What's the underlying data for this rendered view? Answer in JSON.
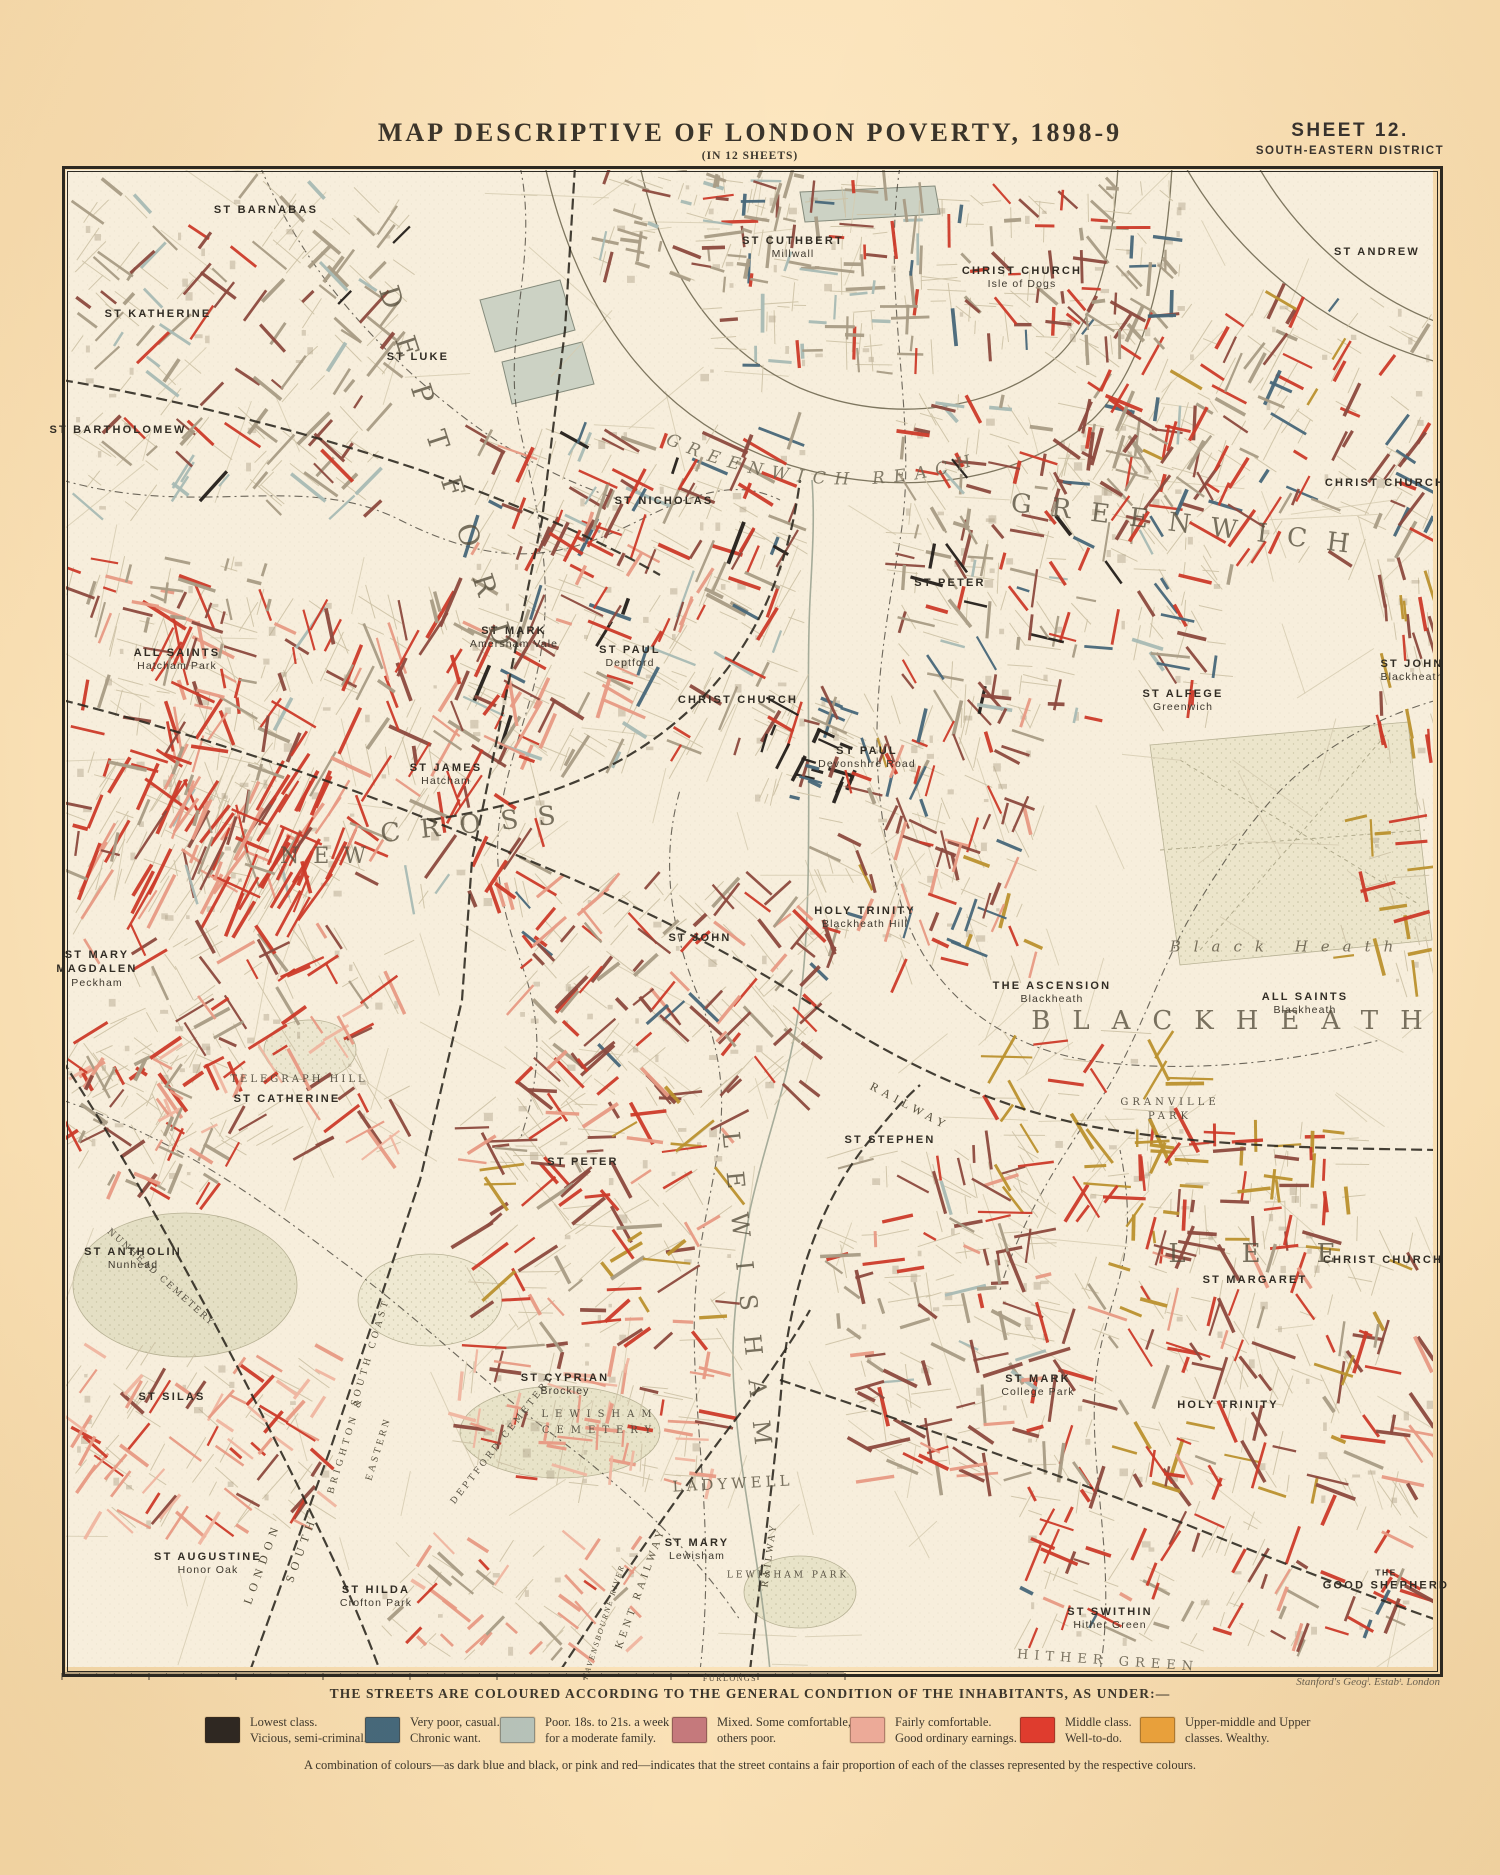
{
  "header": {
    "title": "MAP DESCRIPTIVE OF LONDON POVERTY, 1898-9",
    "subtitle": "(IN 12 SHEETS)",
    "sheet_no": "SHEET 12.",
    "district": "SOUTH-EASTERN DISTRICT"
  },
  "attribution": "Stanford's Geogˡ. Estabᵗ. London",
  "scale_bar": {
    "label": "FURLONGS"
  },
  "legend": {
    "heading": "THE STREETS ARE COLOURED ACCORDING TO THE GENERAL CONDITION OF THE INHABITANTS, AS UNDER:—",
    "items": [
      {
        "color": "#2a2522",
        "lx": 205,
        "lines": [
          "Lowest class.",
          "Vicious, semi-criminal."
        ]
      },
      {
        "color": "#44687c",
        "lx": 365,
        "lines": [
          "Very poor, casual.",
          "Chronic want."
        ]
      },
      {
        "color": "#b7c3ba",
        "lx": 500,
        "lines": [
          "Poor.  18s. to 21s. a week",
          "for a moderate family."
        ]
      },
      {
        "color": "#c5797c",
        "lx": 672,
        "lines": [
          "Mixed.  Some comfortable,",
          "others poor."
        ]
      },
      {
        "color": "#eeab9a",
        "lx": 850,
        "lines": [
          "Fairly comfortable.",
          "Good ordinary earnings."
        ]
      },
      {
        "color": "#e23b2e",
        "lx": 1020,
        "lines": [
          "Middle class.",
          "Well-to-do."
        ]
      },
      {
        "color": "#eca33c",
        "lx": 1140,
        "lines": [
          "Upper-middle and Upper",
          "classes.   Wealthy."
        ]
      }
    ],
    "note": "A combination of colours—as dark blue and black, or pink and red—indicates that the street contains a fair proportion of each of the classes represented by the respective colours."
  },
  "map": {
    "water_label": {
      "t": "GREENWICH REACH"
    },
    "place_labels": [
      {
        "t": "ST BARNABAS",
        "x": 266,
        "y": 210
      },
      {
        "t": "ST KATHERINE",
        "x": 158,
        "y": 314
      },
      {
        "t": "ST BARTHOLOMEW",
        "x": 118,
        "y": 430
      },
      {
        "t": "ST LUKE",
        "x": 418,
        "y": 357
      },
      {
        "t": "ST CUTHBERT",
        "s": [
          "Millwall"
        ],
        "x": 793,
        "y": 248
      },
      {
        "t": "CHRIST CHURCH",
        "s": [
          "Isle of Dogs"
        ],
        "x": 1022,
        "y": 278
      },
      {
        "t": "ST ANDREW",
        "x": 1377,
        "y": 252
      },
      {
        "t": "CHRIST CHURCH",
        "x": 1385,
        "y": 483
      },
      {
        "t": "ST NICHOLAS",
        "x": 664,
        "y": 501
      },
      {
        "t": "ST PETER",
        "x": 950,
        "y": 583
      },
      {
        "t": "ST MARK",
        "s": [
          "Amersham Vale"
        ],
        "x": 514,
        "y": 638
      },
      {
        "t": "ST PAUL",
        "s": [
          "Deptford"
        ],
        "x": 630,
        "y": 657
      },
      {
        "t": "CHRIST CHURCH",
        "x": 738,
        "y": 700
      },
      {
        "t": "ST ALFEGE",
        "s": [
          "Greenwich"
        ],
        "x": 1183,
        "y": 701
      },
      {
        "t": "ST JOHN",
        "s": [
          "Blackheath"
        ],
        "x": 1412,
        "y": 671
      },
      {
        "t": "ALL SAINTS",
        "s": [
          "Hatcham Park"
        ],
        "x": 177,
        "y": 660
      },
      {
        "t": "ST JAMES",
        "s": [
          "Hatcham"
        ],
        "x": 446,
        "y": 775
      },
      {
        "t": "ST PAUL",
        "s": [
          "Devonshire Road"
        ],
        "x": 867,
        "y": 758
      },
      {
        "t": "HOLY TRINITY",
        "s": [
          "Blackheath Hill"
        ],
        "x": 865,
        "y": 918
      },
      {
        "t": "ST JOHN",
        "x": 700,
        "y": 938
      },
      {
        "t": "THE ASCENSION",
        "s": [
          "Blackheath"
        ],
        "x": 1052,
        "y": 993
      },
      {
        "t": "ALL SAINTS",
        "s": [
          "Blackheath"
        ],
        "x": 1305,
        "y": 1004
      },
      {
        "t": "ST MARY",
        "t2": "MAGDALEN",
        "s": [
          "Peckham"
        ],
        "x": 97,
        "y": 969
      },
      {
        "t": "ST CATHERINE",
        "x": 287,
        "y": 1099
      },
      {
        "t": "ST PETER",
        "x": 583,
        "y": 1162
      },
      {
        "t": "ST STEPHEN",
        "x": 890,
        "y": 1140
      },
      {
        "t": "ST ANTHOLIN",
        "s": [
          "Nunhead"
        ],
        "x": 133,
        "y": 1259
      },
      {
        "t": "ST SILAS",
        "x": 172,
        "y": 1397
      },
      {
        "t": "ST MARK",
        "s": [
          "College Park"
        ],
        "x": 1038,
        "y": 1386
      },
      {
        "t": "HOLY TRINITY",
        "x": 1228,
        "y": 1405
      },
      {
        "t": "CHRIST CHURCH",
        "x": 1383,
        "y": 1260
      },
      {
        "t": "ST MARGARET",
        "x": 1255,
        "y": 1280
      },
      {
        "t": "GOOD SHEPHERD",
        "pre": "THE",
        "x": 1386,
        "y": 1580
      },
      {
        "t": "ST SWITHIN",
        "s": [
          "Hither Green"
        ],
        "x": 1110,
        "y": 1619
      },
      {
        "t": "ST CYPRIAN",
        "s": [
          "Brockley"
        ],
        "x": 565,
        "y": 1385
      },
      {
        "t": "ST MARY",
        "s": [
          "Lewisham"
        ],
        "x": 697,
        "y": 1550
      },
      {
        "t": "ST HILDA",
        "s": [
          "Crofton Park"
        ],
        "x": 376,
        "y": 1597
      },
      {
        "t": "ST AUGUSTINE",
        "s": [
          "Honor Oak"
        ],
        "x": 208,
        "y": 1564
      },
      {
        "t": "DEPTFORD",
        "x": 450,
        "y": 480,
        "rot": 72,
        "fs": 28,
        "ls": 30,
        "cls": "big"
      },
      {
        "t": "NEW",
        "x": 330,
        "y": 857,
        "fs": 22,
        "ls": 14,
        "cls": "big"
      },
      {
        "t": "CROSS",
        "x": 478,
        "y": 824,
        "rot": -6,
        "fs": 26,
        "ls": 20,
        "cls": "big"
      },
      {
        "t": "GREENWICH",
        "x": 1190,
        "y": 525,
        "rot": 7,
        "fs": 26,
        "ls": 20,
        "cls": "big"
      },
      {
        "t": "BLACKHEATH",
        "x": 1238,
        "y": 1021,
        "fs": 26,
        "ls": 22,
        "cls": "big"
      },
      {
        "t": "LEWISHAM",
        "x": 748,
        "y": 1300,
        "rot": 84,
        "fs": 24,
        "ls": 24,
        "cls": "big"
      },
      {
        "t": "LEE",
        "x": 1280,
        "y": 1254,
        "fs": 26,
        "ls": 56,
        "cls": "big"
      },
      {
        "t": "LADYWELL",
        "x": 733,
        "y": 1484,
        "rot": -3,
        "fs": 15,
        "ls": 4,
        "cls": "big"
      },
      {
        "t": "HITHER GREEN",
        "x": 1108,
        "y": 1661,
        "rot": 4,
        "fs": 13,
        "ls": 6,
        "cls": "big"
      },
      {
        "t": "Black Heath",
        "x": 1288,
        "y": 947,
        "fs": 15,
        "ls": 13,
        "cls": "big",
        "it": 1
      },
      {
        "t": "TELEGRAPH HILL",
        "x": 299,
        "y": 1080,
        "fs": 10,
        "ls": 3,
        "cls": "small"
      },
      {
        "t": "GRANVILLE",
        "x": 1170,
        "y": 1103,
        "fs": 10,
        "ls": 4,
        "cls": "small"
      },
      {
        "t": "PARK",
        "x": 1170,
        "y": 1117,
        "fs": 10,
        "ls": 4,
        "cls": "small"
      },
      {
        "t": "LEWISHAM PARK",
        "x": 788,
        "y": 1576,
        "fs": 9,
        "ls": 3,
        "cls": "small"
      },
      {
        "t": "LEWISHAM",
        "x": 600,
        "y": 1415,
        "fs": 10,
        "ls": 7,
        "cls": "small"
      },
      {
        "t": "CEMETERY",
        "x": 600,
        "y": 1431,
        "fs": 10,
        "ls": 7,
        "cls": "small"
      },
      {
        "t": "DEPTFORD CEMETERY",
        "x": 503,
        "y": 1440,
        "rot": -52,
        "fs": 9,
        "ls": 3,
        "cls": "small"
      },
      {
        "t": "NUNHEAD CEMETERY",
        "x": 160,
        "y": 1278,
        "rot": 42,
        "fs": 9,
        "ls": 2,
        "cls": "small"
      },
      {
        "t": "LONDON",
        "x": 262,
        "y": 1563,
        "rot": -70,
        "fs": 12,
        "ls": 6,
        "cls": "rail"
      },
      {
        "t": "SOUTH",
        "x": 301,
        "y": 1549,
        "rot": -70,
        "fs": 12,
        "ls": 6,
        "cls": "rail"
      },
      {
        "t": "BRIGHTON &",
        "x": 346,
        "y": 1445,
        "rot": -73,
        "fs": 10,
        "ls": 4,
        "cls": "rail"
      },
      {
        "t": "SOUTH COAST",
        "x": 371,
        "y": 1352,
        "rot": -73,
        "fs": 10,
        "ls": 4,
        "cls": "rail"
      },
      {
        "t": "EASTERN",
        "x": 379,
        "y": 1449,
        "rot": -73,
        "fs": 10,
        "ls": 3,
        "cls": "rail"
      },
      {
        "t": "RAILWAY",
        "x": 910,
        "y": 1106,
        "rot": 28,
        "fs": 12,
        "ls": 5,
        "cls": "rail"
      },
      {
        "t": "KENT RAILWAY",
        "x": 641,
        "y": 1588,
        "rot": -70,
        "fs": 11,
        "ls": 4,
        "cls": "rail"
      },
      {
        "t": "RAILWAY",
        "x": 770,
        "y": 1555,
        "rot": -82,
        "fs": 10,
        "ls": 3,
        "cls": "rail"
      },
      {
        "t": "RAVENSBOURNE RIVER",
        "x": 604,
        "y": 1622,
        "rot": -72,
        "fs": 8,
        "ls": 2,
        "cls": "rail",
        "it": 1
      }
    ]
  }
}
